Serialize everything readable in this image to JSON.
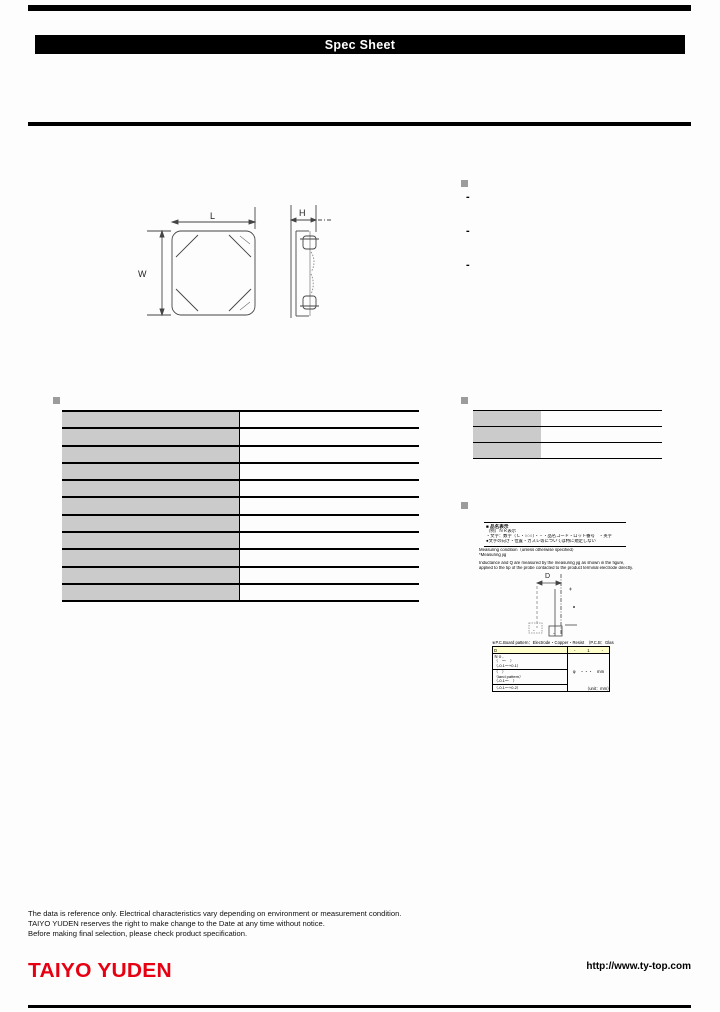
{
  "banner": {
    "title": "Spec Sheet"
  },
  "dimensions": {
    "length_label": "L",
    "width_label": "W",
    "height_label": "H",
    "land_label": "D"
  },
  "features": {
    "items": [
      "-",
      "-",
      "-"
    ]
  },
  "spec_table": {
    "rows": [
      {
        "label": "",
        "value": ""
      },
      {
        "label": "",
        "value": ""
      },
      {
        "label": "",
        "value": ""
      },
      {
        "label": "",
        "value": ""
      },
      {
        "label": "",
        "value": ""
      },
      {
        "label": "",
        "value": ""
      },
      {
        "label": "",
        "value": ""
      },
      {
        "label": "",
        "value": ""
      },
      {
        "label": "",
        "value": ""
      },
      {
        "label": "",
        "value": ""
      },
      {
        "label": "",
        "value": ""
      }
    ]
  },
  "info_table": {
    "rows": [
      {
        "label": "",
        "value": ""
      },
      {
        "label": "",
        "value": ""
      },
      {
        "label": "",
        "value": ""
      }
    ]
  },
  "marking_box": {
    "title": "■ 品名表示",
    "lines": [
      "（例）ＮＲ表示",
      "・文字：数字（Ｃ・○○○）・・・品名コード・ロット番号　・英字",
      "●文字の向き・位置・カスレ等については特に規定しない"
    ]
  },
  "measuring_notes": {
    "jig_lines": [
      "Measuring condition（unless otherwise specified）",
      "*Measuring jig"
    ],
    "detail_lines": [
      "Inductance and Q are measured by the measuring jig as shown in the figure,",
      "applied to the tip of the probe contacted to the product terminal electrode directly."
    ]
  },
  "land_table": {
    "caption": "※P.C.Board pattern：Electrode・Copper・Resist　（P.C.B：Glass epoxy）",
    "header": {
      "label": "D",
      "values": [
        "-",
        "1",
        "-"
      ]
    },
    "left_top": [
      "Ｎｏ．",
      "（　～　）",
      "（-0.1～+0.1）"
    ],
    "left_mid": [
      "（　）",
      "（land pattern）",
      "（-0.1～　）"
    ],
    "left_bottom": [
      "（-0.1～+0.2）"
    ],
    "right_cell": "φ　・・・　mm",
    "unit_note": "（unit：mm）"
  },
  "footer": {
    "notes": [
      "The data is reference only. Electrical characteristics vary depending on environment or measurement condition.",
      "TAIYO YUDEN reserves the right to make change to the Date at any time without notice.",
      "Before making final selection, please check product specification."
    ],
    "logo": "TAIYO YUDEN",
    "url": "http://www.ty-top.com"
  },
  "colors": {
    "accent_red": "#e60012",
    "cell_gray": "#cbcbcb",
    "highlight_yellow": "#ffffcc",
    "bullet_gray": "#9c9c9c",
    "bar_black": "#000000"
  }
}
